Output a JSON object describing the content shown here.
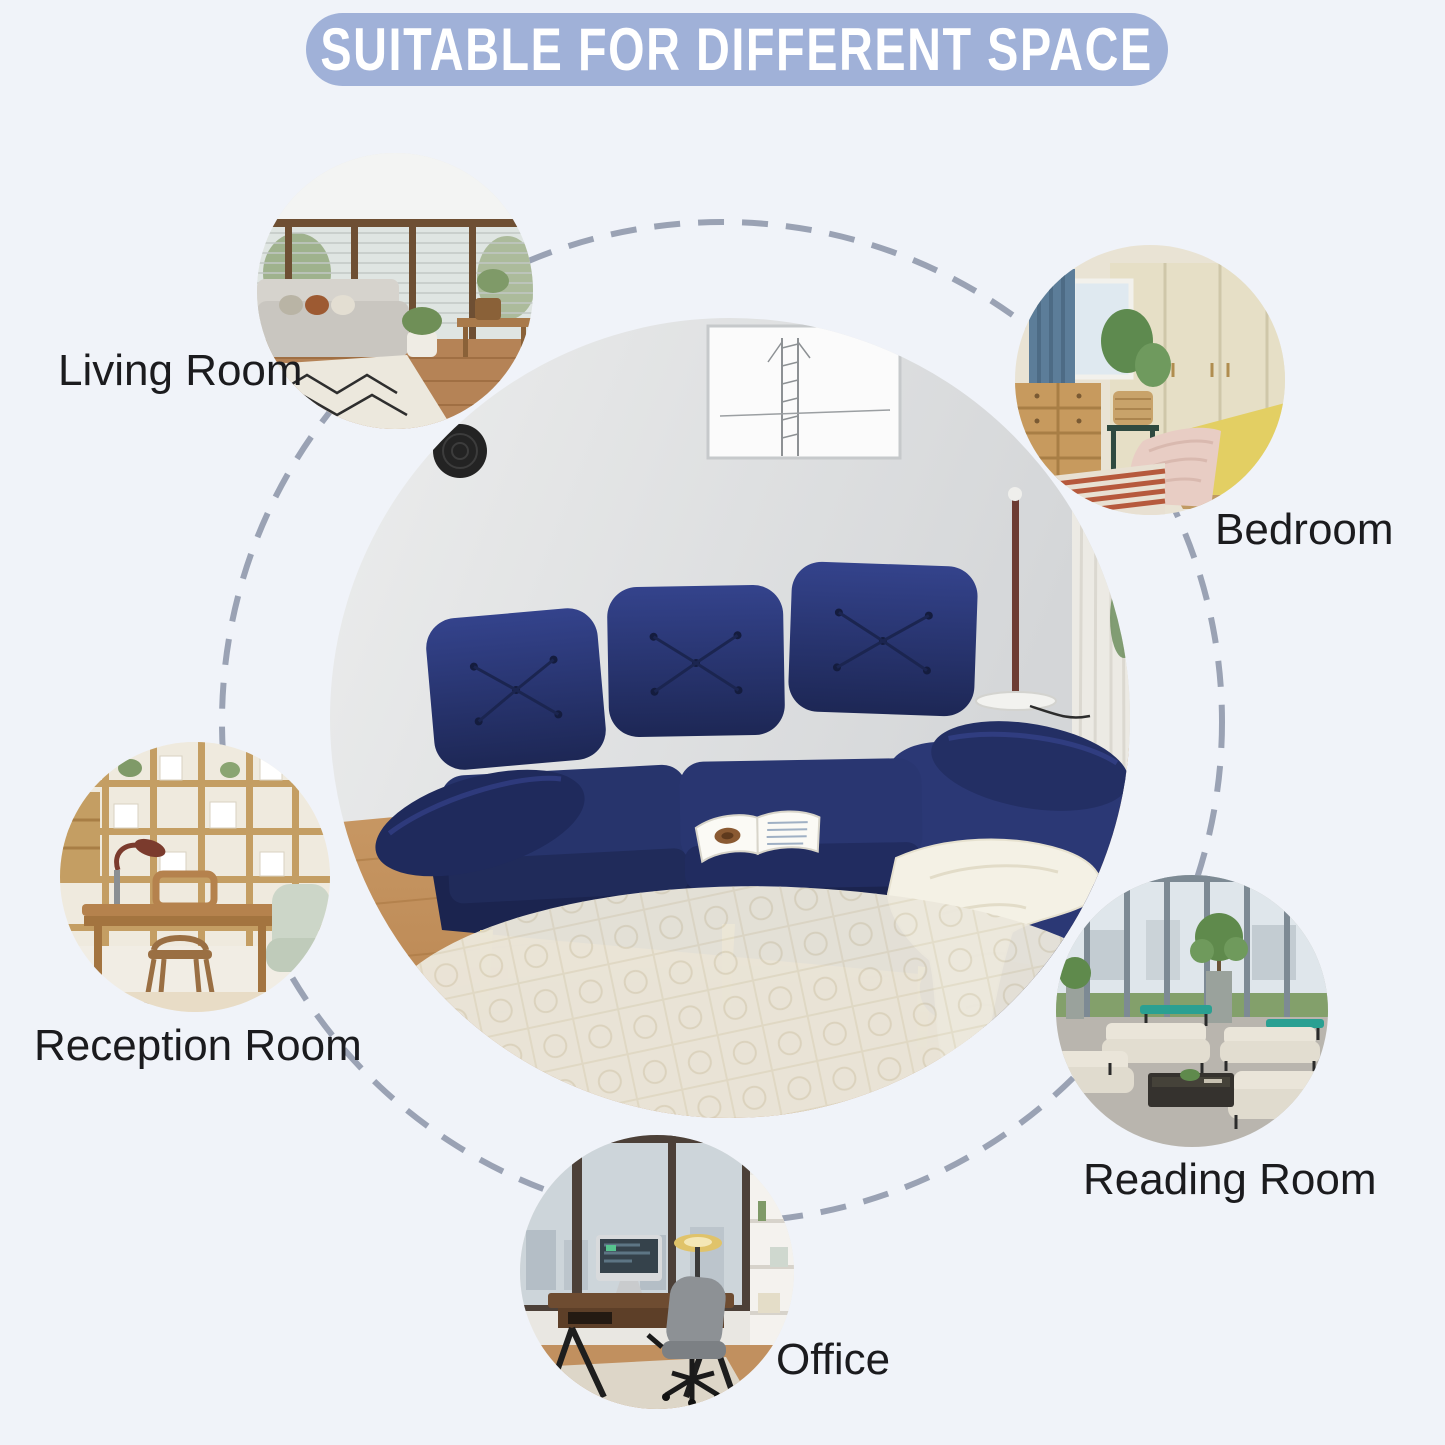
{
  "banner": {
    "title": "SUITABLE FOR DIFFERENT SPACE"
  },
  "colors": {
    "background": "#f0f3f9",
    "banner_bg": "#a0b1d8",
    "banner_text": "#ffffff",
    "label_text": "#1b1b1e",
    "dash": "#9aa2b4",
    "sofa_navy": "#27346c",
    "sofa_navy_dark": "#1b244f",
    "sofa_gold": "#c9a43e",
    "throw_white": "#f4f1e5"
  },
  "spaces": [
    {
      "id": "living-room",
      "label": "Living Room"
    },
    {
      "id": "bedroom",
      "label": "Bedroom"
    },
    {
      "id": "reception-room",
      "label": "Reception Room"
    },
    {
      "id": "reading-room",
      "label": "Reading Room"
    },
    {
      "id": "office",
      "label": "Office"
    }
  ]
}
